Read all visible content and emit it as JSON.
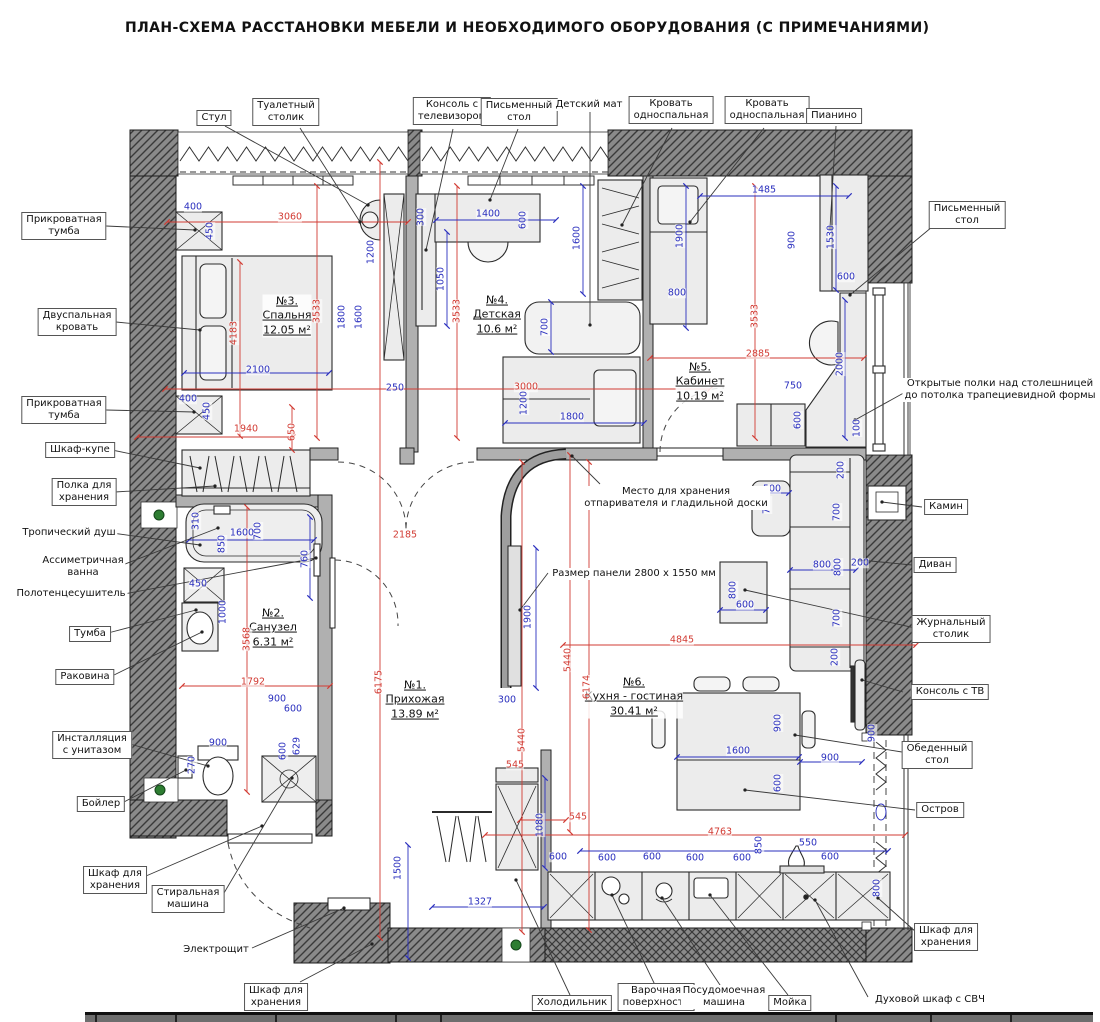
{
  "title": "ПЛАН-СХЕМА РАССТАНОВКИ МЕБЕЛИ И НЕОБХОДИМОГО ОБОРУДОВАНИЯ (С ПРИМЕЧАНИЯМИ)",
  "colors": {
    "dim_red": "#d23b33",
    "dim_blue": "#2a2fbe",
    "wall_fill": "#8a8a8a",
    "furniture_fill": "#ececec",
    "vent_green": "#2e7d32"
  },
  "rooms": [
    [
      287,
      316,
      "№3.",
      "Спальня",
      "12.05 м²"
    ],
    [
      497,
      315,
      "№4.",
      "Детская",
      "10.6 м²"
    ],
    [
      700,
      382,
      "№5.",
      "Кабинет",
      "10.19 м²"
    ],
    [
      273,
      628,
      "№2.",
      "Санузел",
      "6.31 м²"
    ],
    [
      415,
      700,
      "№1.",
      "Прихожая",
      "13.89 м²"
    ],
    [
      634,
      697,
      "№6.",
      "Кухня - гостиная",
      "30.41 м²"
    ]
  ],
  "callouts": [
    [
      214,
      118,
      1,
      [
        "Стул"
      ]
    ],
    [
      286,
      112,
      1,
      [
        "Туалетный",
        "столик"
      ]
    ],
    [
      452,
      111,
      1,
      [
        "Консоль с",
        "телевизором"
      ]
    ],
    [
      519,
      112,
      1,
      [
        "Письменный",
        "стол"
      ]
    ],
    [
      589,
      105,
      0,
      [
        "Детский мат"
      ]
    ],
    [
      671,
      110,
      1,
      [
        "Кровать",
        "односпальная"
      ]
    ],
    [
      767,
      110,
      1,
      [
        "Кровать",
        "односпальная"
      ]
    ],
    [
      834,
      116,
      1,
      [
        "Пианино"
      ]
    ],
    [
      967,
      215,
      1,
      [
        "Письменный",
        "стол"
      ]
    ],
    [
      1000,
      390,
      0,
      [
        "Открытые полки над столешницей",
        "до потолка трапециевидной формы"
      ]
    ],
    [
      946,
      507,
      1,
      [
        "Камин"
      ]
    ],
    [
      935,
      565,
      1,
      [
        "Диван"
      ]
    ],
    [
      951,
      629,
      1,
      [
        "Журнальный",
        "столик"
      ]
    ],
    [
      950,
      692,
      1,
      [
        "Консоль с ТВ"
      ]
    ],
    [
      937,
      755,
      1,
      [
        "Обеденный",
        "стол"
      ]
    ],
    [
      940,
      810,
      1,
      [
        "Остров"
      ]
    ],
    [
      946,
      937,
      1,
      [
        "Шкаф для",
        "хранения"
      ]
    ],
    [
      930,
      1000,
      0,
      [
        "Духовой шкаф с СВЧ"
      ]
    ],
    [
      572,
      1003,
      1,
      [
        "Холодильник"
      ]
    ],
    [
      656,
      997,
      1,
      [
        "Варочная",
        "поверхность"
      ]
    ],
    [
      724,
      997,
      0,
      [
        "Посудомоечная",
        "машина"
      ]
    ],
    [
      790,
      1003,
      1,
      [
        "Мойка"
      ]
    ],
    [
      64,
      226,
      1,
      [
        "Прикроватная",
        "тумба"
      ]
    ],
    [
      77,
      322,
      1,
      [
        "Двуспальная",
        "кровать"
      ]
    ],
    [
      64,
      410,
      1,
      [
        "Прикроватная",
        "тумба"
      ]
    ],
    [
      80,
      450,
      1,
      [
        "Шкаф-купе"
      ]
    ],
    [
      84,
      492,
      1,
      [
        "Полка для",
        "хранения"
      ]
    ],
    [
      69,
      533,
      0,
      [
        "Тропический душ"
      ]
    ],
    [
      83,
      567,
      0,
      [
        "Ассиметричная",
        "ванна"
      ]
    ],
    [
      71,
      594,
      0,
      [
        "Полотенцесушитель"
      ]
    ],
    [
      90,
      634,
      1,
      [
        "Тумба"
      ]
    ],
    [
      85,
      677,
      1,
      [
        "Раковина"
      ]
    ],
    [
      92,
      745,
      1,
      [
        "Инсталляция",
        "с унитазом"
      ]
    ],
    [
      101,
      804,
      1,
      [
        "Бойлер"
      ]
    ],
    [
      115,
      880,
      1,
      [
        "Шкаф для",
        "хранения"
      ]
    ],
    [
      188,
      899,
      1,
      [
        "Стиральная",
        "машина"
      ]
    ],
    [
      216,
      950,
      0,
      [
        "Электрощит"
      ]
    ],
    [
      276,
      997,
      1,
      [
        "Шкаф для",
        "хранения"
      ]
    ],
    [
      676,
      498,
      0,
      [
        "Место для хранения",
        "отпаривателя и гладильной доски"
      ]
    ],
    [
      634,
      574,
      0,
      [
        "Размер панели 2800 х 1550 мм"
      ]
    ]
  ],
  "leaders": [
    [
      225,
      126,
      368,
      205
    ],
    [
      300,
      128,
      360,
      222
    ],
    [
      453,
      129,
      426,
      250
    ],
    [
      518,
      129,
      490,
      200
    ],
    [
      590,
      112,
      590,
      325
    ],
    [
      672,
      128,
      622,
      225
    ],
    [
      764,
      128,
      690,
      222
    ],
    [
      836,
      126,
      830,
      228
    ],
    [
      938,
      222,
      850,
      295
    ],
    [
      918,
      385,
      855,
      420
    ],
    [
      922,
      507,
      882,
      502
    ],
    [
      912,
      565,
      860,
      560
    ],
    [
      915,
      628,
      745,
      590
    ],
    [
      903,
      692,
      862,
      680
    ],
    [
      902,
      752,
      795,
      735
    ],
    [
      915,
      810,
      745,
      790
    ],
    [
      916,
      932,
      878,
      898
    ],
    [
      868,
      997,
      815,
      900
    ],
    [
      788,
      995,
      710,
      895
    ],
    [
      722,
      988,
      662,
      898
    ],
    [
      655,
      985,
      612,
      895
    ],
    [
      570,
      995,
      516,
      880
    ],
    [
      106,
      226,
      195,
      230
    ],
    [
      116,
      322,
      200,
      330
    ],
    [
      106,
      410,
      194,
      412
    ],
    [
      112,
      450,
      200,
      468
    ],
    [
      115,
      492,
      215,
      486
    ],
    [
      112,
      533,
      200,
      545
    ],
    [
      120,
      566,
      218,
      528
    ],
    [
      124,
      594,
      316,
      558
    ],
    [
      108,
      633,
      196,
      610
    ],
    [
      112,
      676,
      202,
      632
    ],
    [
      130,
      744,
      208,
      766
    ],
    [
      122,
      803,
      186,
      770
    ],
    [
      146,
      876,
      262,
      826
    ],
    [
      224,
      893,
      292,
      778
    ],
    [
      252,
      948,
      344,
      908
    ],
    [
      300,
      982,
      372,
      944
    ],
    [
      600,
      484,
      572,
      456
    ],
    [
      548,
      573,
      520,
      610
    ]
  ],
  "dims": [
    [
      193,
      207,
      "400",
      "b",
      0
    ],
    [
      210,
      231,
      "450",
      "b",
      1
    ],
    [
      290,
      217,
      "3060",
      "r",
      0
    ],
    [
      234,
      333,
      "4183",
      "r",
      1
    ],
    [
      317,
      311,
      "3533",
      "r",
      1
    ],
    [
      258,
      370,
      "2100",
      "b",
      0
    ],
    [
      188,
      399,
      "400",
      "b",
      0
    ],
    [
      207,
      411,
      "450",
      "b",
      1
    ],
    [
      246,
      429,
      "1940",
      "r",
      0
    ],
    [
      292,
      432,
      "650",
      "r",
      1
    ],
    [
      371,
      252,
      "1200",
      "b",
      1
    ],
    [
      342,
      317,
      "1800",
      "b",
      1
    ],
    [
      359,
      317,
      "1600",
      "b",
      1
    ],
    [
      395,
      388,
      "250",
      "b",
      0
    ],
    [
      421,
      217,
      "300",
      "b",
      1
    ],
    [
      488,
      214,
      "1400",
      "b",
      0
    ],
    [
      523,
      220,
      "600",
      "b",
      1
    ],
    [
      441,
      279,
      "1050",
      "b",
      1
    ],
    [
      577,
      238,
      "1600",
      "b",
      1
    ],
    [
      545,
      327,
      "700",
      "b",
      1
    ],
    [
      526,
      387,
      "3000",
      "r",
      0
    ],
    [
      524,
      403,
      "1200",
      "b",
      1
    ],
    [
      572,
      417,
      "1800",
      "b",
      0
    ],
    [
      457,
      311,
      "3533",
      "r",
      1
    ],
    [
      764,
      190,
      "1485",
      "b",
      0
    ],
    [
      680,
      236,
      "1900",
      "b",
      1
    ],
    [
      792,
      240,
      "900",
      "b",
      1
    ],
    [
      831,
      237,
      "1530",
      "b",
      1
    ],
    [
      677,
      293,
      "800",
      "b",
      0
    ],
    [
      846,
      277,
      "600",
      "b",
      0
    ],
    [
      755,
      316,
      "3533",
      "r",
      1
    ],
    [
      758,
      354,
      "2885",
      "r",
      0
    ],
    [
      840,
      364,
      "2000",
      "b",
      1
    ],
    [
      793,
      386,
      "750",
      "b",
      0
    ],
    [
      798,
      420,
      "600",
      "b",
      1
    ],
    [
      857,
      428,
      "100",
      "b",
      1
    ],
    [
      196,
      521,
      "310",
      "b",
      1
    ],
    [
      242,
      533,
      "1600",
      "b",
      0
    ],
    [
      258,
      531,
      "700",
      "b",
      1
    ],
    [
      222,
      544,
      "850",
      "b",
      1
    ],
    [
      198,
      584,
      "450",
      "b",
      0
    ],
    [
      223,
      612,
      "1000",
      "b",
      1
    ],
    [
      305,
      559,
      "760",
      "b",
      1
    ],
    [
      247,
      639,
      "3568",
      "r",
      1
    ],
    [
      253,
      682,
      "1792",
      "r",
      0
    ],
    [
      277,
      699,
      "900",
      "b",
      0
    ],
    [
      293,
      709,
      "600",
      "b",
      0
    ],
    [
      218,
      743,
      "900",
      "b",
      0
    ],
    [
      283,
      751,
      "600",
      "b",
      1
    ],
    [
      297,
      746,
      "629",
      "b",
      1
    ],
    [
      192,
      765,
      "270",
      "b",
      1
    ],
    [
      379,
      682,
      "6175",
      "r",
      1
    ],
    [
      405,
      535,
      "2185",
      "r",
      0
    ],
    [
      507,
      700,
      "300",
      "b",
      0
    ],
    [
      522,
      740,
      "5440",
      "r",
      1
    ],
    [
      515,
      765,
      "545",
      "r",
      0
    ],
    [
      540,
      825,
      "1080",
      "b",
      1
    ],
    [
      398,
      868,
      "1500",
      "b",
      1
    ],
    [
      480,
      902,
      "1327",
      "b",
      0
    ],
    [
      558,
      857,
      "600",
      "b",
      0
    ],
    [
      528,
      617,
      "1900",
      "b",
      1
    ],
    [
      568,
      660,
      "5440",
      "r",
      1
    ],
    [
      587,
      687,
      "6174",
      "r",
      1
    ],
    [
      682,
      640,
      "4845",
      "r",
      0
    ],
    [
      720,
      832,
      "4763",
      "r",
      0
    ],
    [
      578,
      817,
      "545",
      "r",
      0
    ],
    [
      759,
      845,
      "850",
      "b",
      1
    ],
    [
      808,
      843,
      "550",
      "b",
      0
    ],
    [
      607,
      858,
      "600",
      "b",
      0
    ],
    [
      652,
      857,
      "600",
      "b",
      0
    ],
    [
      695,
      858,
      "600",
      "b",
      0
    ],
    [
      742,
      858,
      "600",
      "b",
      0
    ],
    [
      830,
      857,
      "600",
      "b",
      0
    ],
    [
      872,
      733,
      "900",
      "b",
      1
    ],
    [
      830,
      758,
      "900",
      "b",
      0
    ],
    [
      738,
      751,
      "1600",
      "b",
      0
    ],
    [
      778,
      783,
      "600",
      "b",
      1
    ],
    [
      778,
      723,
      "900",
      "b",
      1
    ],
    [
      877,
      888,
      "800",
      "b",
      1
    ],
    [
      772,
      489,
      "500",
      "b",
      0
    ],
    [
      767,
      505,
      "700",
      "b",
      1
    ],
    [
      837,
      512,
      "700",
      "b",
      1
    ],
    [
      841,
      470,
      "200",
      "b",
      1
    ],
    [
      822,
      565,
      "800",
      "b",
      0
    ],
    [
      838,
      567,
      "800",
      "b",
      1
    ],
    [
      860,
      563,
      "200",
      "b",
      0
    ],
    [
      745,
      605,
      "600",
      "b",
      0
    ],
    [
      733,
      590,
      "800",
      "b",
      1
    ],
    [
      837,
      618,
      "700",
      "b",
      1
    ],
    [
      835,
      657,
      "200",
      "b",
      1
    ]
  ],
  "dim_lines": [
    [
      167,
      222,
      408,
      222,
      "r"
    ],
    [
      240,
      262,
      240,
      436,
      "r"
    ],
    [
      317,
      186,
      317,
      438,
      "r"
    ],
    [
      457,
      186,
      457,
      438,
      "r"
    ],
    [
      755,
      186,
      755,
      438,
      "r"
    ],
    [
      165,
      389,
      710,
      389,
      "r"
    ],
    [
      650,
      358,
      864,
      358,
      "r"
    ],
    [
      137,
      437,
      293,
      437,
      "r"
    ],
    [
      182,
      686,
      330,
      686,
      "r"
    ],
    [
      563,
      645,
      916,
      645,
      "r"
    ],
    [
      485,
      835,
      905,
      835,
      "r"
    ],
    [
      380,
      162,
      380,
      938,
      "r"
    ],
    [
      247,
      507,
      247,
      792,
      "r"
    ],
    [
      522,
      462,
      522,
      932,
      "r"
    ],
    [
      589,
      462,
      589,
      930,
      "r"
    ],
    [
      570,
      455,
      570,
      832,
      "r"
    ],
    [
      292,
      407,
      292,
      450,
      "r"
    ],
    [
      520,
      820,
      566,
      820,
      "r"
    ],
    [
      184,
      373,
      329,
      373,
      "b"
    ],
    [
      436,
      220,
      556,
      220,
      "b"
    ],
    [
      700,
      196,
      849,
      196,
      "b"
    ],
    [
      189,
      540,
      314,
      540,
      "b"
    ],
    [
      580,
      851,
      888,
      851,
      "b"
    ],
    [
      432,
      907,
      544,
      907,
      "b"
    ],
    [
      677,
      757,
      799,
      757,
      "b"
    ],
    [
      845,
      300,
      845,
      438,
      "b"
    ],
    [
      836,
      186,
      836,
      290,
      "b"
    ],
    [
      686,
      186,
      686,
      328,
      "b"
    ],
    [
      536,
      548,
      536,
      688,
      "b"
    ],
    [
      545,
      778,
      545,
      868,
      "b"
    ],
    [
      408,
      845,
      408,
      958,
      "b"
    ],
    [
      447,
      232,
      447,
      326,
      "b"
    ],
    [
      583,
      186,
      583,
      294,
      "b"
    ],
    [
      551,
      302,
      551,
      352,
      "b"
    ],
    [
      505,
      423,
      644,
      423,
      "b"
    ],
    [
      310,
      517,
      310,
      598,
      "b"
    ],
    [
      800,
      762,
      862,
      762,
      "b"
    ],
    [
      752,
      493,
      789,
      493,
      "b"
    ],
    [
      720,
      610,
      766,
      610,
      "b"
    ],
    [
      790,
      570,
      856,
      570,
      "b"
    ]
  ]
}
